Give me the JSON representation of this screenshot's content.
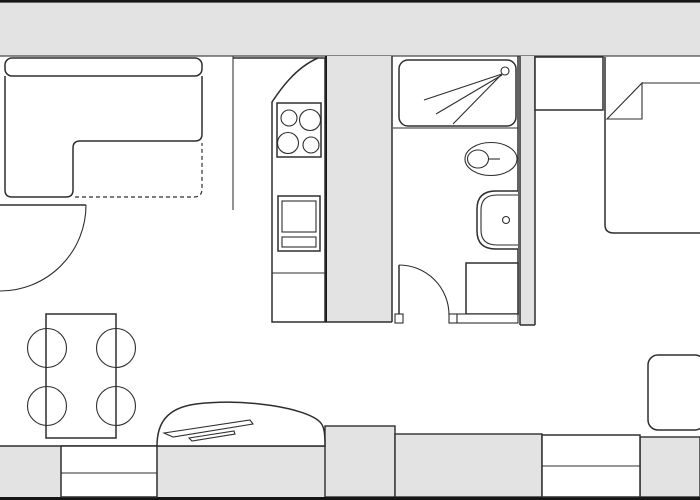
{
  "floorplan": {
    "colors": {
      "background": "#ffffff",
      "wall_fill": "#e3e3e3",
      "line": "#2e2e2e",
      "line_soft": "#4a4a4a",
      "line_strong": "#161616"
    },
    "walls": [
      "top-wall-band",
      "kitchen-bathroom-partition",
      "bathroom-bedroom-partition",
      "bottom-wall-band"
    ],
    "windows": [
      "bottom-left-window",
      "bottom-right-window"
    ],
    "doors": [
      "entry-door",
      "bathroom-door"
    ],
    "fixtures": [
      "corner-sofa",
      "sofa-bed-extension-dashed",
      "dining-table",
      "dining-chairs",
      "kitchen-counter",
      "cooktop-four-burners",
      "oven",
      "kitchen-island-curved",
      "island-faucet-detail",
      "shower",
      "shower-head-spray",
      "toilet",
      "wash-basin",
      "washing-machine",
      "wardrobe",
      "bed-with-folded-blanket",
      "armchair"
    ]
  }
}
